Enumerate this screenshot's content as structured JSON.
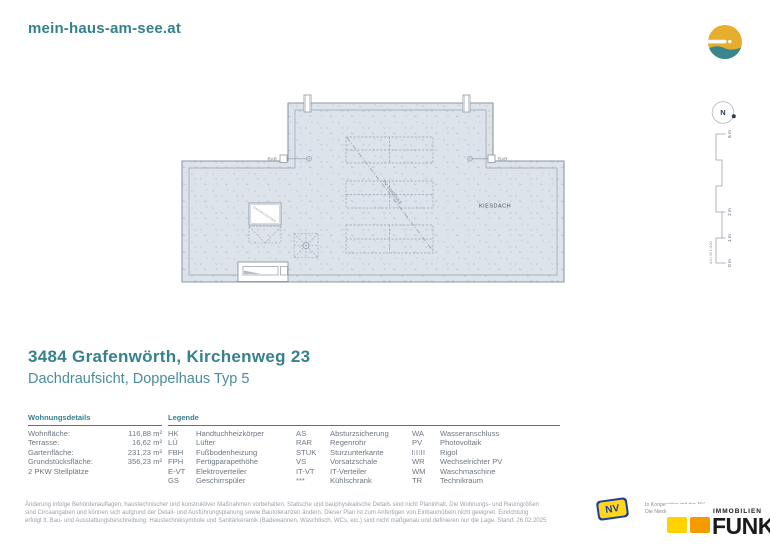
{
  "brand": {
    "site": "mein-haus-am-see.at"
  },
  "plan": {
    "kiesdach_label": "KIESDACH",
    "rar_label": "RAR",
    "pv_line_label": "PV: 6 MODULE",
    "hatch_label": "DACHAUSSTIEG"
  },
  "compass": {
    "north_label": "N"
  },
  "scalebar": {
    "labels": [
      "5 m",
      "2 m",
      "1 m",
      "0 m"
    ],
    "sheet_label": "A4 / M 1:200"
  },
  "title": {
    "address": "3484 Grafenwörth, Kirchenweg 23",
    "subtitle": "Dachdraufsicht, Doppelhaus Typ 5"
  },
  "details": {
    "heading": "Wohnungsdetails",
    "rows": [
      {
        "label": "Wohnfläche:",
        "value": "116,88 m²"
      },
      {
        "label": "Terrasse:",
        "value": "16,62 m²"
      },
      {
        "label": "Gartenfläche:",
        "value": "231,23 m²"
      },
      {
        "label": "Grundstücksfläche:",
        "value": "356,23 m²"
      },
      {
        "label": "2 PKW Stellplätze",
        "value": ""
      }
    ]
  },
  "legend": {
    "heading": "Legende",
    "col1": [
      {
        "abbr": "HK",
        "label": "Handtuchheizkörper"
      },
      {
        "abbr": "LÜ",
        "label": "Lüfter"
      },
      {
        "abbr": "FBH",
        "label": "Fußbodenheizung"
      },
      {
        "abbr": "FPH",
        "label": "Fertigparapethöhe"
      },
      {
        "abbr": "E-VT",
        "label": "Elektroverteiler"
      },
      {
        "abbr": "GS",
        "label": "Geschirrspüler"
      }
    ],
    "col2": [
      {
        "abbr": "AS",
        "label": "Absturzsicherung"
      },
      {
        "abbr": "RAR",
        "label": "Regenrohr"
      },
      {
        "abbr": "STUK",
        "label": "Sturzunterkante"
      },
      {
        "abbr": "VS",
        "label": "Vorsatzschale"
      },
      {
        "abbr": "IT-VT",
        "label": "IT-Verteiler"
      },
      {
        "abbr": "***",
        "label": "Kühlschrank"
      }
    ],
    "col3": [
      {
        "abbr": "WA",
        "label": "Wasseranschluss"
      },
      {
        "abbr": "PV",
        "label": "Photovoltaik"
      },
      {
        "abbr": "",
        "label": "Rigol"
      },
      {
        "abbr": "WR",
        "label": "Wechselrichter PV"
      },
      {
        "abbr": "WM",
        "label": "Waschmaschine"
      },
      {
        "abbr": "TR",
        "label": "Technikraum"
      }
    ]
  },
  "disclaimer": {
    "lines": [
      "Änderung infolge Behördenauflagen, haustechnischer und konstruktiver Maßnahmen vorbehalten. Statische und bauphysikalische Details sind nicht Planinhalt. Die Wohnungs- und Raumgrößen",
      "sind Circaangaben und können sich aufgrund der Detail- und Ausführungsplanung sowie Bautoleranzen ändern. Dieser Plan ist zum Anfertigen von Einbaumöbeln nicht geeignet. Einrichtung",
      "erfolgt lt. Bau- und Ausstattungsbeschreibung. Haustechniksymbole und Sanitärkeramik (Badewannen, Waschtisch, WCs, etc.) sind nicht maßgenau und definieren nur die Lage. Stand: 26.02.2025"
    ]
  },
  "footer": {
    "nv_text": "NV",
    "coop_line1": "In Kooperation mit der NV.",
    "coop_line2": "Die Niederösterreichische Versicherung",
    "funk_top": "IMMOBILIEN",
    "funk_bottom": "FUNK"
  },
  "colors": {
    "teal": "#35818e",
    "roof_fill": "#dce3ea",
    "roof_stroke": "#8e97a1",
    "nv_blue": "#1e3f94",
    "nv_yellow": "#ffd51e",
    "funk_yellow": "#ffd200",
    "funk_orange": "#f59b00",
    "sun_gold": "#e7ae2e"
  }
}
